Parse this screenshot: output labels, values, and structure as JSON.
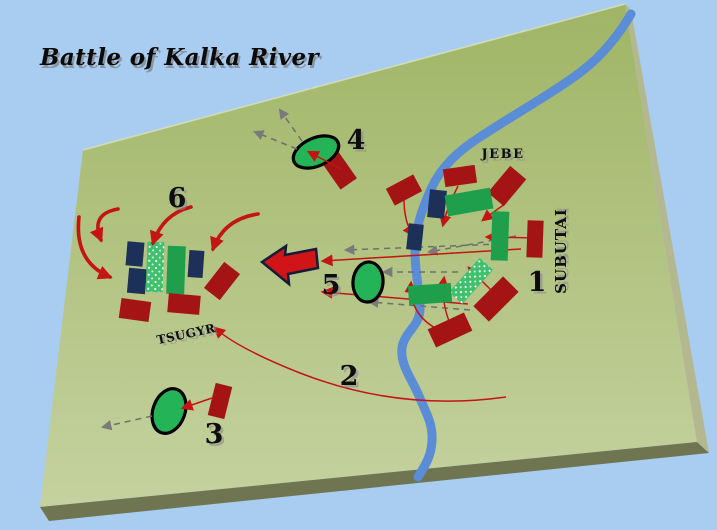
{
  "title": "Battle of Kalka River",
  "colors": {
    "background": "#a9ccf1",
    "board_top": "#a0b668",
    "board_bottom": "#c6d2a0",
    "board_edge_highlight": "#d8dfb8",
    "bevel_bottom": "#6e7550",
    "bevel_right": "#b3b88e",
    "river": "#5b8cd6",
    "unit_red": "#a41414",
    "unit_navy": "#1d3057",
    "unit_green": "#1f9e4c",
    "unit_stipple": "#3fc06c",
    "ellipse_green": "#25b357",
    "ellipse_stroke": "#000000",
    "arrow_red": "#c41414",
    "arrow_gray": "#6f6f6f",
    "big_arrow_fill": "#d11418",
    "big_arrow_stroke": "#131c38",
    "label_color": "#0d0d0d",
    "label_shadow": "#8b8b8b"
  },
  "board": {
    "top_face": "83,150 625,4 697,442 40,507",
    "top_edge_highlight": "83,150 625,4",
    "bevel_bottom": "40,507 697,442 709,453 49,521",
    "bevel_right": "625,4 631,10 709,453 697,442"
  },
  "river": {
    "name": "Kalka river",
    "path": "M631,14 C620,33 603,55 582,71 C556,91 515,114 480,137 C458,151 441,167 431,189 C421,211 415,230 415,252 C415,274 420,291 420,309 C420,326 404,332 402,348 C400,365 412,379 419,396 C426,413 433,423 432,441 C431,459 423,468 418,477",
    "width": 9
  },
  "units": [
    {
      "id": "left-navy-1",
      "type": "navy",
      "cx": 135,
      "cy": 254,
      "w": 17,
      "h": 24,
      "rot": 5
    },
    {
      "id": "left-navy-2",
      "type": "navy",
      "cx": 137,
      "cy": 281,
      "w": 18,
      "h": 25,
      "rot": 5
    },
    {
      "id": "left-stipple",
      "type": "stipple",
      "cx": 155,
      "cy": 267,
      "w": 17,
      "h": 50,
      "rot": 2
    },
    {
      "id": "left-green",
      "type": "green",
      "cx": 176,
      "cy": 270,
      "w": 18,
      "h": 48,
      "rot": 2
    },
    {
      "id": "left-navy-3",
      "type": "navy",
      "cx": 196,
      "cy": 264,
      "w": 15,
      "h": 27,
      "rot": 4
    },
    {
      "id": "left-red-1",
      "type": "red",
      "cx": 135,
      "cy": 310,
      "w": 30,
      "h": 20,
      "rot": 8
    },
    {
      "id": "left-red-2",
      "type": "red",
      "cx": 184,
      "cy": 304,
      "w": 32,
      "h": 19,
      "rot": 5
    },
    {
      "id": "left-red-3",
      "type": "red",
      "cx": 222,
      "cy": 281,
      "w": 20,
      "h": 33,
      "rot": 38
    },
    {
      "id": "camp4-red",
      "type": "red",
      "cx": 339,
      "cy": 170,
      "w": 20,
      "h": 34,
      "rot": -35
    },
    {
      "id": "camp3-red",
      "type": "red",
      "cx": 220,
      "cy": 401,
      "w": 17,
      "h": 33,
      "rot": 14
    },
    {
      "id": "jebe-red-1",
      "type": "red",
      "cx": 404,
      "cy": 190,
      "w": 31,
      "h": 19,
      "rot": -28
    },
    {
      "id": "jebe-red-2",
      "type": "red",
      "cx": 460,
      "cy": 176,
      "w": 32,
      "h": 18,
      "rot": -8
    },
    {
      "id": "jebe-red-3",
      "type": "red",
      "cx": 507,
      "cy": 186,
      "w": 21,
      "h": 35,
      "rot": 40
    },
    {
      "id": "jebe-navy-1",
      "type": "navy",
      "cx": 437,
      "cy": 204,
      "w": 17,
      "h": 28,
      "rot": 6
    },
    {
      "id": "jebe-green-1",
      "type": "green",
      "cx": 469,
      "cy": 202,
      "w": 46,
      "h": 21,
      "rot": -10
    },
    {
      "id": "jebe-navy-2",
      "type": "navy",
      "cx": 415,
      "cy": 237,
      "w": 15,
      "h": 26,
      "rot": 6
    },
    {
      "id": "subutai-green-tall",
      "type": "green",
      "cx": 500,
      "cy": 236,
      "w": 17,
      "h": 49,
      "rot": 2
    },
    {
      "id": "subutai-red-tall",
      "type": "red",
      "cx": 535,
      "cy": 239,
      "w": 16,
      "h": 37,
      "rot": 2
    },
    {
      "id": "subutai-stipple",
      "type": "stipple",
      "cx": 471,
      "cy": 281,
      "w": 18,
      "h": 46,
      "rot": 42
    },
    {
      "id": "subutai-green-wide",
      "type": "green",
      "cx": 430,
      "cy": 294,
      "w": 43,
      "h": 19,
      "rot": -4
    },
    {
      "id": "subutai-red-se",
      "type": "red",
      "cx": 496,
      "cy": 299,
      "w": 22,
      "h": 42,
      "rot": 45
    },
    {
      "id": "subutai-red-s",
      "type": "red",
      "cx": 450,
      "cy": 330,
      "w": 40,
      "h": 20,
      "rot": -25
    }
  ],
  "ellipses": [
    {
      "id": "cavalry-ellipse-4",
      "cx": 316,
      "cy": 152,
      "rx": 24,
      "ry": 14,
      "rot": -24
    },
    {
      "id": "cavalry-ellipse-5",
      "cx": 368,
      "cy": 282,
      "rx": 15,
      "ry": 20,
      "rot": 5
    },
    {
      "id": "cavalry-ellipse-3",
      "cx": 169,
      "cy": 411,
      "rx": 16,
      "ry": 23,
      "rot": 20
    }
  ],
  "arrows": {
    "dashed_under": [
      {
        "id": "retreat-dashed-1",
        "d": "M500,244 L346,250"
      },
      {
        "id": "retreat-dashed-2",
        "d": "M516,236 L429,252"
      },
      {
        "id": "retreat-dashed-3",
        "d": "M470,310 L370,302"
      },
      {
        "id": "retreat-dashed-4",
        "d": "M458,272 L384,272"
      }
    ],
    "red_under": [
      {
        "id": "flank-route-2",
        "d": "M506,397 Q400,412 300,373 Q237,348 215,328"
      },
      {
        "id": "pursuit-arrow-1",
        "d": "M521,249 L323,261"
      },
      {
        "id": "pursuit-arrow-2",
        "d": "M468,304 L323,292"
      },
      {
        "id": "pursuit-arrow-3",
        "d": "M536,238 L487,237"
      },
      {
        "id": "jebe-attack-1",
        "d": "M404,199 Q404,222 413,235"
      },
      {
        "id": "jebe-attack-2",
        "d": "M458,186 Q447,208 443,225"
      },
      {
        "id": "jebe-attack-3",
        "d": "M505,204 Q492,213 483,220"
      },
      {
        "id": "subutai-attack-1",
        "d": "M437,329 Q409,314 411,283"
      },
      {
        "id": "subutai-attack-2",
        "d": "M449,321 Q441,300 444,278"
      },
      {
        "id": "subutai-attack-3",
        "d": "M491,290 L469,268"
      }
    ],
    "arcs": [
      {
        "id": "encircle-arrow-1",
        "d": "M118,209 Q90,214 101,240"
      },
      {
        "id": "encircle-arrow-2",
        "d": "M79,217 Q74,262 110,277"
      },
      {
        "id": "encircle-arrow-3",
        "d": "M191,207 Q163,214 153,243"
      },
      {
        "id": "encircle-arrow-4",
        "d": "M258,214 Q224,219 213,249"
      }
    ],
    "over": [
      {
        "id": "camp4-attack-arrow",
        "d": "M341,169 L309,152",
        "dashed": false
      },
      {
        "id": "camp3-attack-arrow",
        "d": "M212,398 L183,408",
        "dashed": false
      },
      {
        "id": "camp4-flee-1",
        "d": "M302,141 L280,110",
        "dashed": true
      },
      {
        "id": "camp4-flee-2",
        "d": "M297,149 L255,132",
        "dashed": true
      },
      {
        "id": "camp3-flee",
        "d": "M152,416 L103,427",
        "dashed": true
      }
    ],
    "big_arrow_path": "M262,262 L286,246 L285,255 L316,249 L318,268 L288,274 L289,284 Z"
  },
  "map_labels": [
    {
      "id": "label-jebe",
      "text": "JEBE",
      "x": 503,
      "y": 158,
      "size": 13,
      "rot": 0,
      "ls": 1.5
    },
    {
      "id": "label-subutai",
      "text": "SUBUTAI",
      "x": 566,
      "y": 251,
      "size": 15,
      "rot": -90,
      "ls": 1
    },
    {
      "id": "label-tsugyr",
      "text": "TSUGYR",
      "x": 187,
      "y": 338,
      "size": 12,
      "rot": -12,
      "ls": 0.5
    }
  ],
  "numbers": [
    {
      "value": "1",
      "x": 537,
      "y": 291
    },
    {
      "value": "2",
      "x": 349,
      "y": 385
    },
    {
      "value": "3",
      "x": 214,
      "y": 443
    },
    {
      "value": "4",
      "x": 356,
      "y": 149
    },
    {
      "value": "5",
      "x": 331,
      "y": 294
    },
    {
      "value": "6",
      "x": 177,
      "y": 207
    }
  ]
}
